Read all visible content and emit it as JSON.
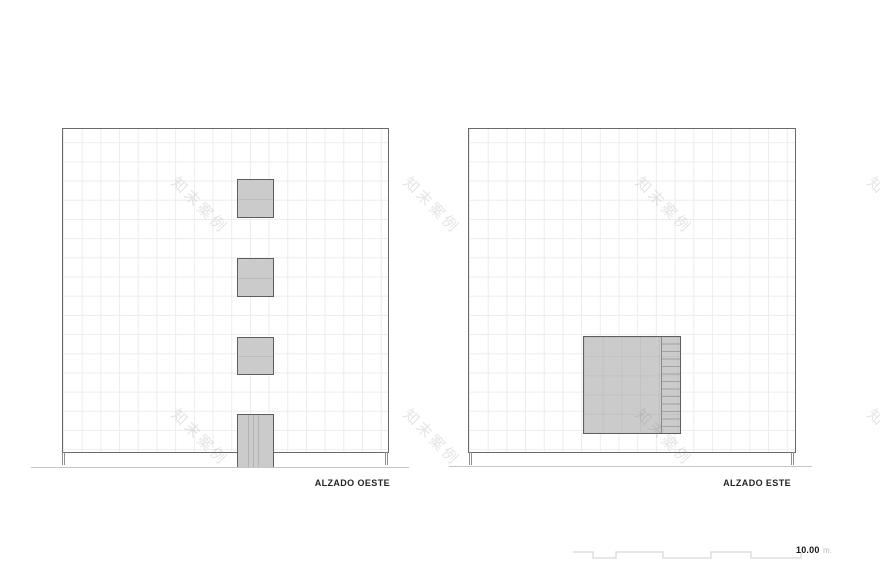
{
  "sheet": {
    "background": "#ffffff",
    "type": "architectural elevation drawings"
  },
  "elevations": {
    "west": {
      "label": "ALZADO OESTE",
      "windows_count": 3,
      "door_count": 1
    },
    "east": {
      "label": "ALZADO ESTE",
      "opening_count": 1,
      "opening_has_ladder": true
    }
  },
  "scale_bar": {
    "value": "10.00",
    "unit": "m."
  },
  "watermark": {
    "text": "知末案例"
  },
  "colors": {
    "wall_outline": "#6a6a6a",
    "grid_line": "#ececec",
    "opening_fill": "#cbcbcb",
    "opening_border": "#5e5e5e",
    "ladder_rung": "#a2a2a2",
    "ground_line": "#c6c6c6",
    "scale_bar_line": "#d8d8d8",
    "label_text": "#242424",
    "scale_value_text": "#161616",
    "scale_unit_text": "#bababa",
    "watermark_text": "rgba(130,130,130,0.22)"
  }
}
